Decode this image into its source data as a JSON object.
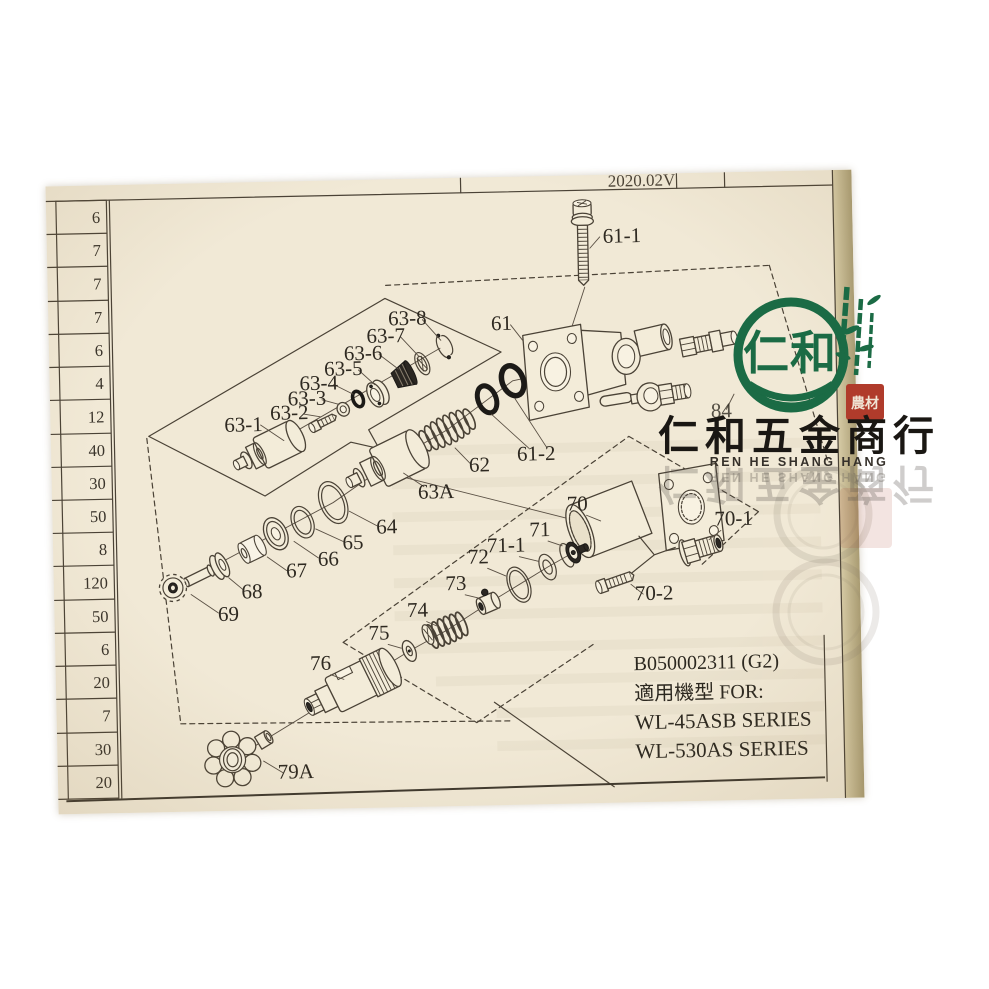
{
  "header": {
    "version": "2020.02V"
  },
  "left_table": {
    "rows": [
      "6",
      "7",
      "7",
      "7",
      "6",
      "4",
      "12",
      "40",
      "30",
      "50",
      "8",
      "120",
      "50",
      "6",
      "20",
      "7",
      "30",
      "20"
    ]
  },
  "diagram": {
    "labels": {
      "n61": "61",
      "n61_1": "61-1",
      "n61_2": "61-2",
      "n62": "62",
      "n63_1": "63-1",
      "n63_2": "63-2",
      "n63_3": "63-3",
      "n63_4": "63-4",
      "n63_5": "63-5",
      "n63_6": "63-6",
      "n63_7": "63-7",
      "n63_8": "63-8",
      "n63A": "63A",
      "n64": "64",
      "n65": "65",
      "n66": "66",
      "n67": "67",
      "n68": "68",
      "n69": "69",
      "n70": "70",
      "n70_1": "70-1",
      "n70_2": "70-2",
      "n71": "71",
      "n71_1": "71-1",
      "n72": "72",
      "n73": "73",
      "n74": "74",
      "n75": "75",
      "n76": "76",
      "n79A": "79A",
      "n84": "84"
    }
  },
  "info_box": {
    "part_no": "B050002311 (G2)",
    "applicable": "適用機型 FOR:",
    "model_1": "WL-45ASB SERIES",
    "model_2": "WL-530AS SERIES"
  },
  "watermark": {
    "logo_text": "仁和",
    "seal_text": "農材",
    "company_cn": "仁和五金商行",
    "company_en": "REN HE SHANG HANG",
    "green": "#1b6b45",
    "red": "#b03b2b"
  },
  "colors": {
    "page": "#f1e9d6",
    "ink": "#4a4236",
    "oring": "#1c1a17"
  }
}
